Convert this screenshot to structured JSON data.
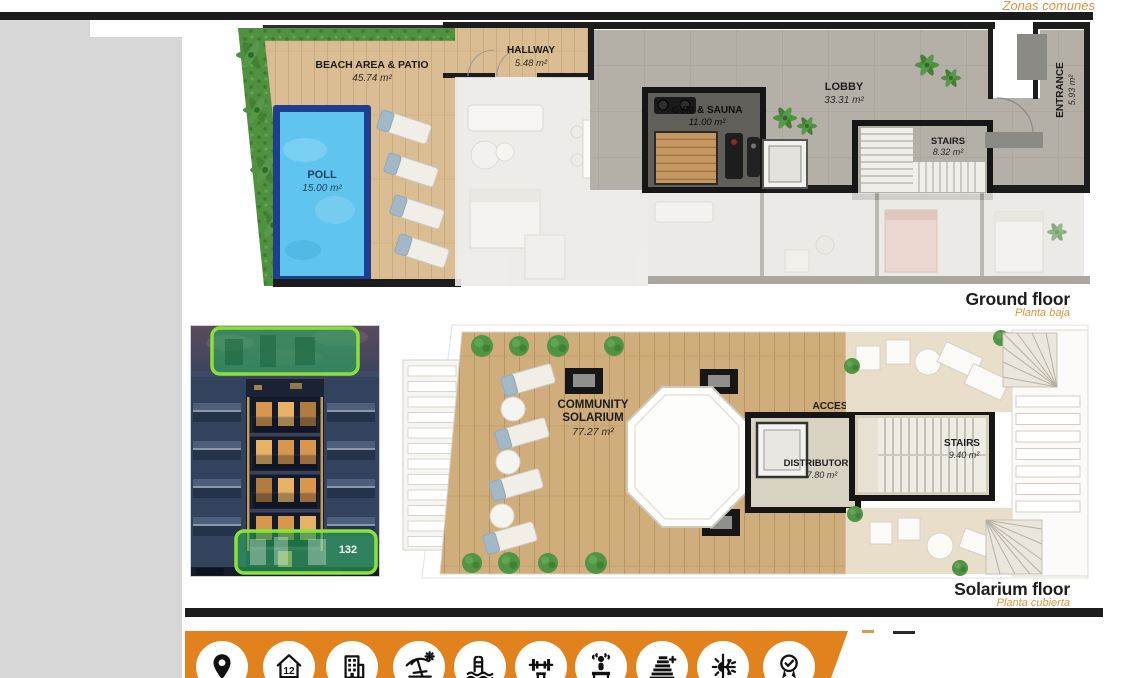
{
  "page": {
    "corner_label": "Zonas comunes"
  },
  "ground_floor": {
    "caption": "Ground floor",
    "caption_es": "Planta baja",
    "rooms": {
      "beach": {
        "name": "BEACH AREA & PATIO",
        "area": "45.74 m²"
      },
      "pool": {
        "name": "POLL",
        "area": "15.00 m²"
      },
      "hallway": {
        "name": "HALLWAY",
        "area": "5.48 m²"
      },
      "gym": {
        "name": "GYM & SAUNA",
        "area": "11.00 m²"
      },
      "lobby": {
        "name": "LOBBY",
        "area": "33.31 m²"
      },
      "stairs": {
        "name": "STAIRS",
        "area": "8.32 m²"
      },
      "entrance": {
        "name": "ENTRANCE",
        "area": "5.93 m²"
      }
    }
  },
  "solarium_floor": {
    "caption": "Solarium floor",
    "caption_es": "Planta cubierta",
    "rooms": {
      "solarium": {
        "line1": "COMMUNITY",
        "line2": "SOLARIUM",
        "area": "77.27 m²"
      },
      "access": {
        "name": "ACCES"
      },
      "distributor": {
        "name": "DISTRIBUTOR",
        "area": "7.80 m²"
      },
      "stairs": {
        "name": "STAIRS",
        "area": "9.40 m²"
      }
    }
  },
  "building_photo": {
    "unit_badge": "132"
  },
  "amenities": {
    "house_number": "12",
    "icons": [
      "location",
      "house-12",
      "building",
      "beach",
      "pool",
      "gym",
      "sauna",
      "energy-rating",
      "climate",
      "quality-medal"
    ]
  },
  "colors": {
    "accent_orange": "#e2821c",
    "caption_orange": "#e0923a",
    "highlight_green": "#8ce03a",
    "pool_blue": "#5fc4ee",
    "wall_black": "#1c1c1c"
  }
}
